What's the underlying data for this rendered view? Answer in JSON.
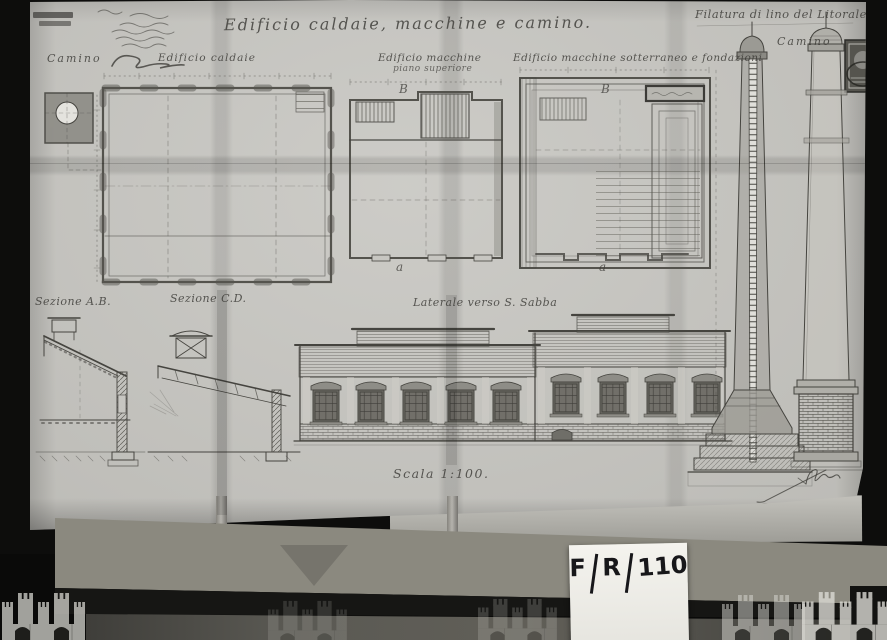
{
  "archive_card": {
    "field1": "F",
    "field2": "R",
    "number": "110"
  },
  "drawing": {
    "title": "Edificio caldaie, macchine e camino.",
    "header_right": "Filatura di lino del Litorale",
    "labels": {
      "camino_left": "Camino",
      "edificio_caldaie": "Edificio caldaie",
      "edificio_macchine": "Edificio macchine",
      "piano_superiore": "piano superiore",
      "edificio_macchine_sotterraneo": "Edificio macchine sotterraneo e fondazioni",
      "camino_right": "Camino",
      "sezione_ab": "Sezione A.B.",
      "sezione_cd": "Sezione C.D.",
      "laterale": "Laterale verso S. Sabba",
      "scala": "Scala 1:100."
    },
    "markers": {
      "b_left": "B",
      "b_right": "B",
      "a_left": "a",
      "a_right": "a"
    }
  }
}
